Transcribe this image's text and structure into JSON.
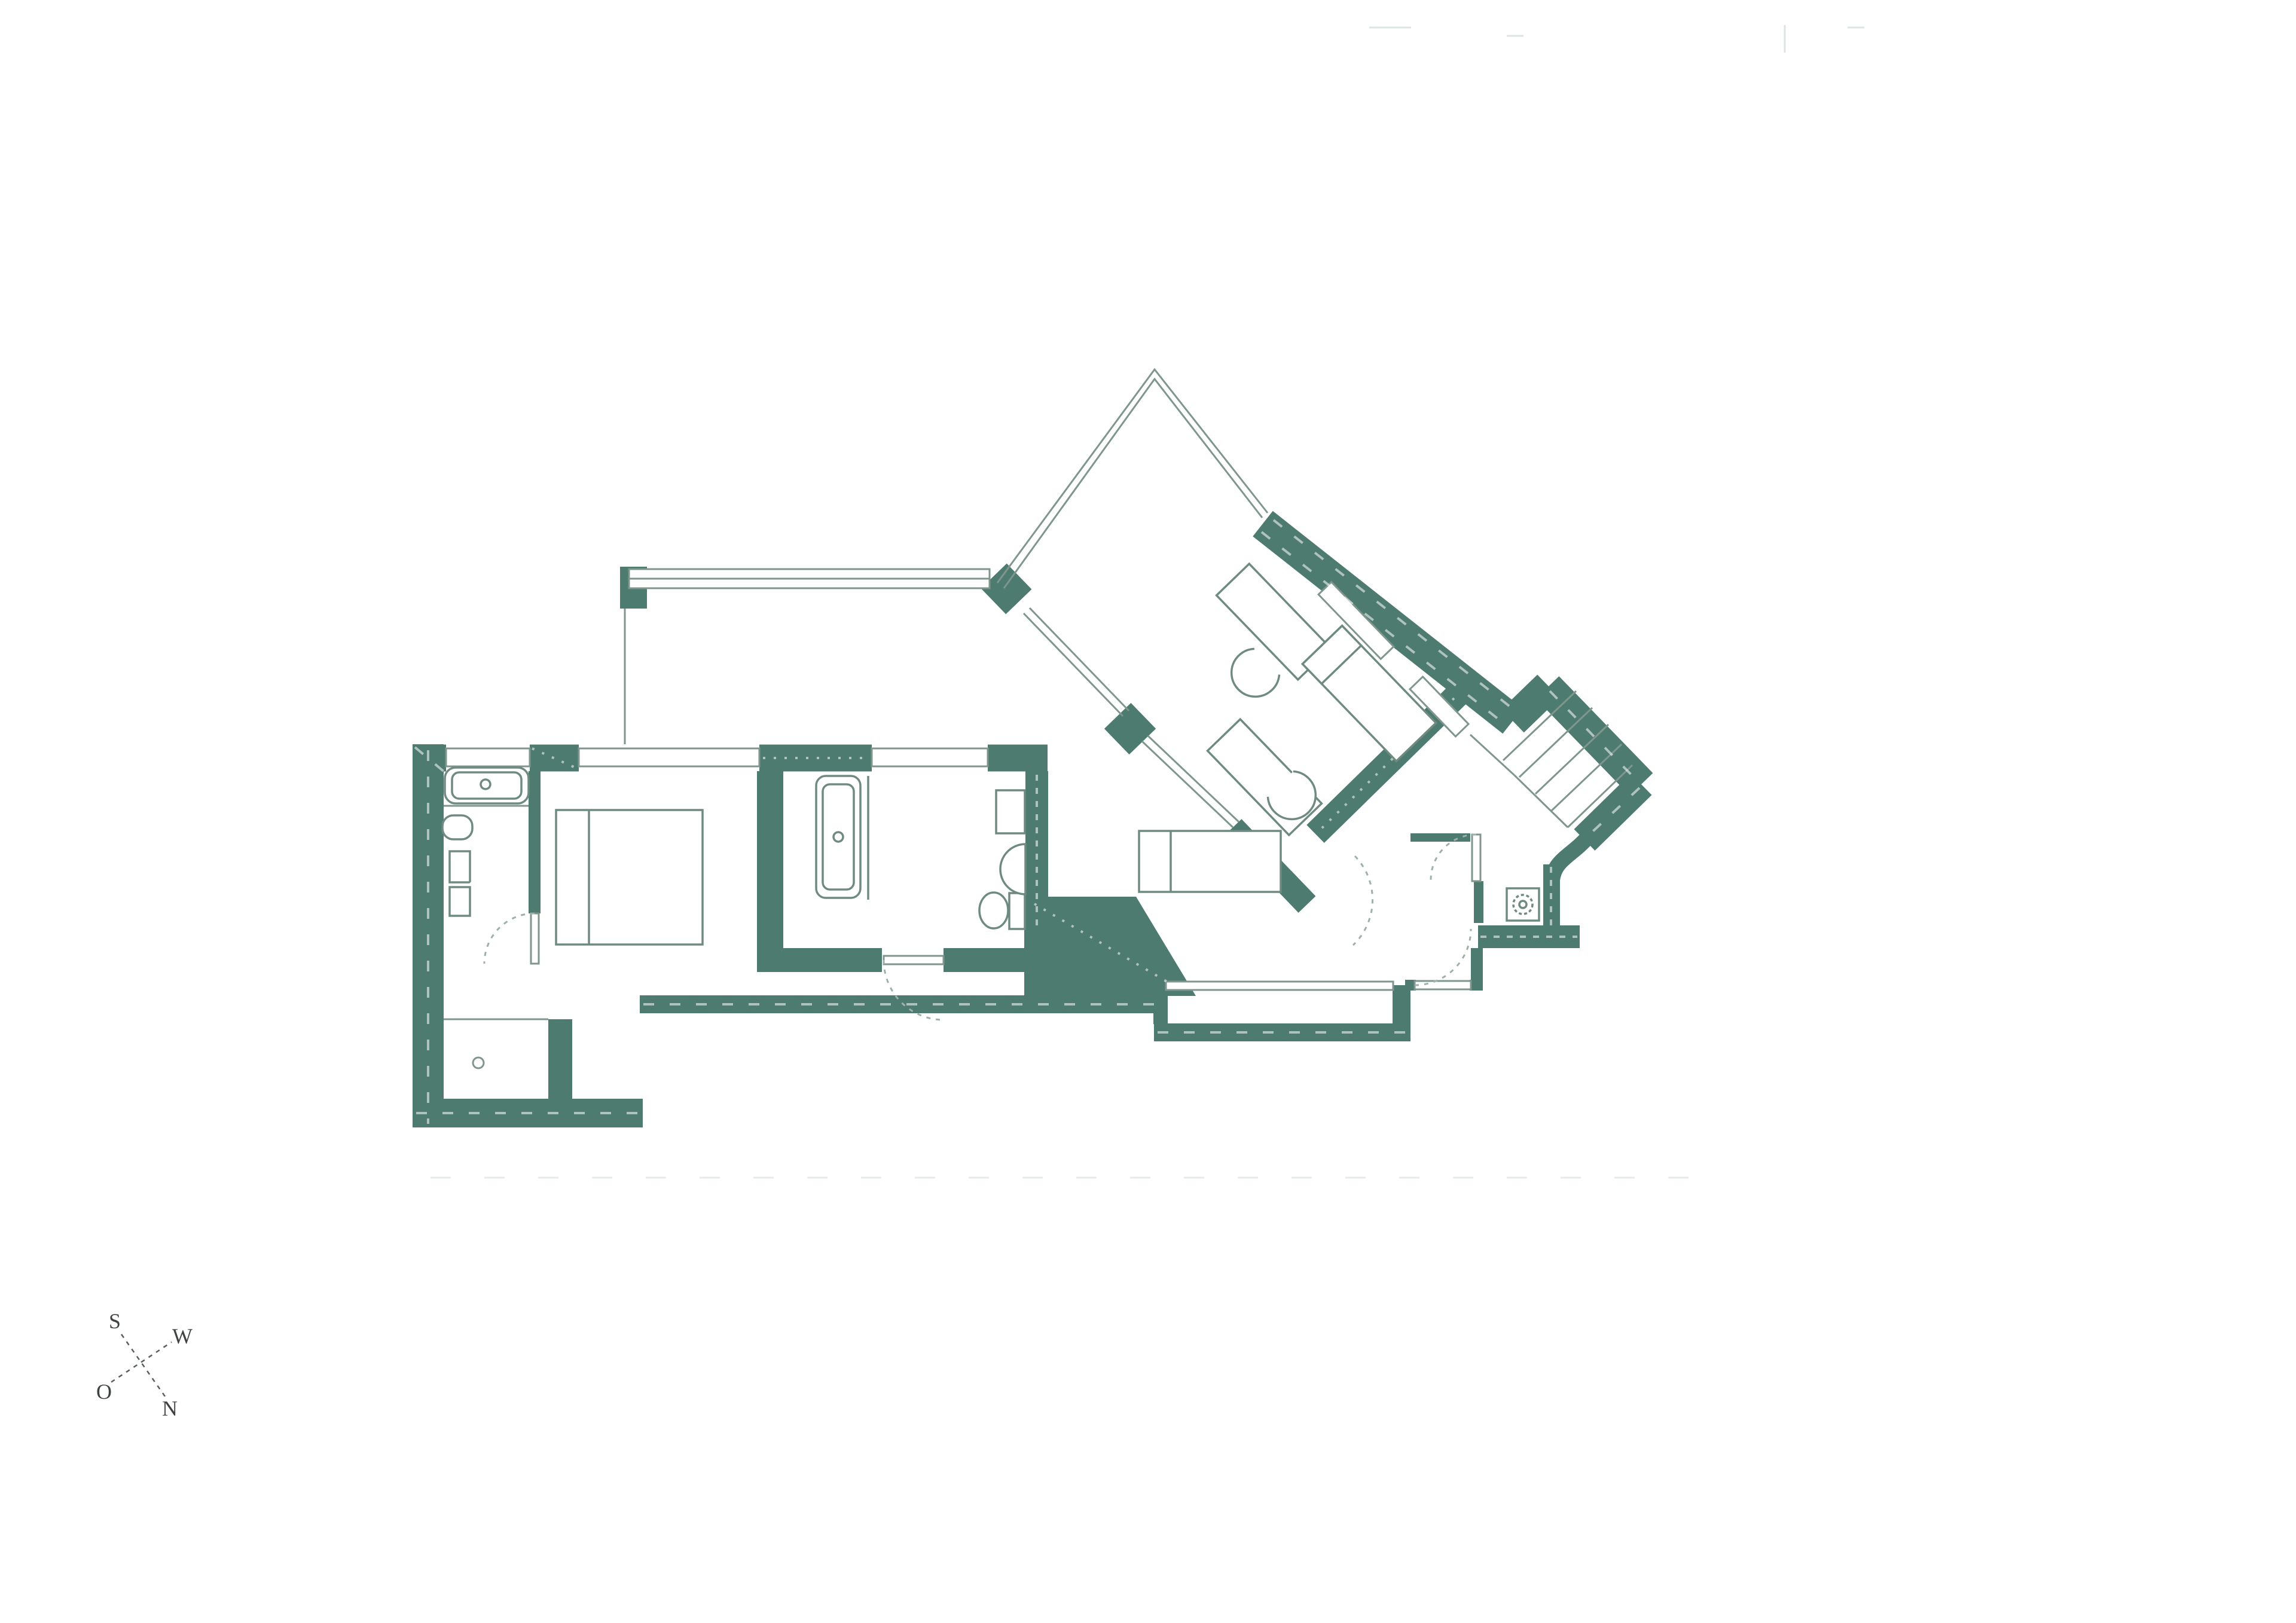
{
  "document": {
    "kind": "architectural-floor-plan",
    "description": "Apartment floor plan with orthogonal west wing, 46-degree rotated east wing, triangular terrace, stair flight at the east tip, recessed loggia on the south side and entry vestibule with washing-machine niche",
    "background_color": "#ffffff"
  },
  "palette": {
    "wall_fill": "#4E7B70",
    "thin_line": "#7F968D",
    "furniture_line": "#6F8A80",
    "door_arc": "#9FB0A8",
    "window_stroke": "#7F968D",
    "hatch_line": "#ffffff",
    "faint_marks": "#C7D2CD",
    "compass_text": "#3F4242",
    "compass_line": "#5A5F5E"
  },
  "compass": {
    "s": "S",
    "w": "W",
    "o": "O",
    "n": "N"
  },
  "fixtures": [
    "bathtub-horizontal",
    "bathtub-vertical",
    "pedestal-sink",
    "wall-sink",
    "vanity-cabinets",
    "toilet",
    "double-bed",
    "single-bed",
    "single-bed-angled",
    "desk-angled",
    "desk-chair",
    "washing-machine",
    "stair-flight",
    "door-swing-arcs",
    "window-bands",
    "terrace-railing",
    "compass-rose"
  ]
}
